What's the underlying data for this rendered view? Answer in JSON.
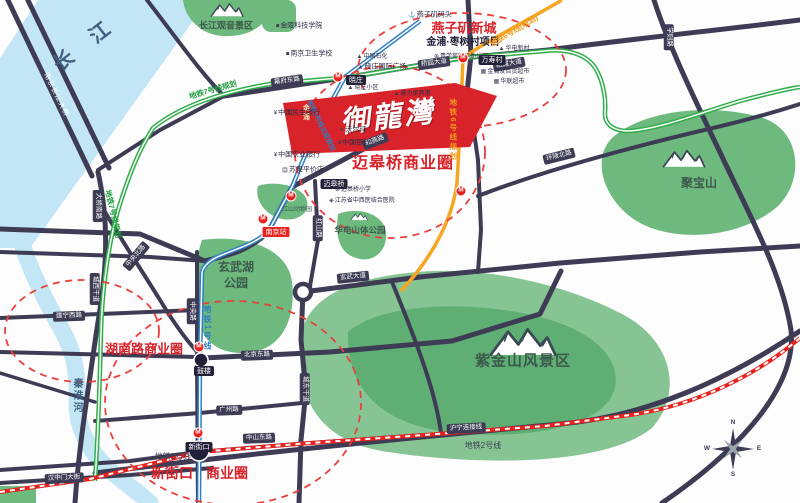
{
  "colors": {
    "road": "#3e3c55",
    "river": "#c2e6f5",
    "park": "#6db97e",
    "park_light": "#86c493",
    "park_dark": "#5fae74",
    "metro_line7": "#2fae4a",
    "metro_line1": "#2e7fc2",
    "metro_line6": "#f5a623",
    "metro_line2": "#e8231f",
    "dashed_circle": "#e8413d",
    "flag": "#d8232a",
    "accent_text": "#d8232a"
  },
  "labels": [
    {
      "name": "yangtze-river-label",
      "text": "长 江",
      "x": 86,
      "y": 44,
      "cls": "river-lg",
      "rot": -38
    },
    {
      "name": "qinhuai-river-label",
      "text": "秦淮河",
      "x": 76,
      "y": 396,
      "cls": "river-sm vtext"
    },
    {
      "name": "bridge-label",
      "text": "南京长江大桥",
      "x": 56,
      "y": 95,
      "cls": "bridge-text",
      "rot": 64
    },
    {
      "name": "guanyin-scenic-label",
      "text": "长江观音景区",
      "x": 226,
      "y": 26,
      "cls": "area area-sm"
    },
    {
      "name": "jubaoshan-label",
      "text": "聚宝山",
      "x": 699,
      "y": 183,
      "cls": "area area-md"
    },
    {
      "name": "xuanwu-lake-label-1",
      "text": "玄武湖",
      "x": 236,
      "y": 267,
      "cls": "area area-md"
    },
    {
      "name": "xuanwu-lake-label-2",
      "text": "公园",
      "x": 236,
      "y": 283,
      "cls": "area area-md"
    },
    {
      "name": "huadian-park-label",
      "text": "华电山体公园",
      "x": 360,
      "y": 230,
      "cls": "area area-xs"
    },
    {
      "name": "zijinshan-label",
      "text": "紫金山风景区",
      "x": 523,
      "y": 361,
      "cls": "area area-lg"
    },
    {
      "name": "hongshan-zoo-label",
      "text": "红山动物园",
      "x": 297,
      "y": 210,
      "cls": "area area-tiny"
    },
    {
      "name": "yanziji-newtown-label",
      "text": "燕子矶新城",
      "x": 464,
      "y": 28,
      "cls": "biz biz-sm"
    },
    {
      "name": "zaoshucun-project-label",
      "text": "金浦·枣树村项目",
      "x": 463,
      "y": 43,
      "cls": "proj"
    },
    {
      "name": "maigaoqiao-biz-label",
      "text": "迈皋桥商业圈",
      "x": 403,
      "y": 164,
      "cls": "biz biz-lg"
    },
    {
      "name": "hunanlu-biz-label",
      "text": "湖南路商业圈",
      "x": 144,
      "y": 349,
      "cls": "biz biz-sm"
    },
    {
      "name": "xinjiekou-biz-label-1",
      "text": "新街口",
      "x": 172,
      "y": 473,
      "cls": "biz biz-md"
    },
    {
      "name": "xinjiekou-biz-label-2",
      "text": "商业圈",
      "x": 227,
      "y": 473,
      "cls": "biz biz-md"
    },
    {
      "name": "flag-brand-small",
      "text": "金浦",
      "x": 306,
      "y": 113,
      "cls": "flag-small vtext"
    },
    {
      "name": "flag-brand-main",
      "text": "御龍灣",
      "x": 388,
      "y": 117,
      "cls": "flag-brand",
      "rot": -7
    },
    {
      "name": "road-tag-daqiaonanlu",
      "text": "大桥南路",
      "x": 98,
      "y": 206,
      "cls": "tag",
      "rot": 90
    },
    {
      "name": "road-tag-chengxigandao",
      "text": "城西干道",
      "x": 95,
      "y": 289,
      "cls": "tag",
      "rot": 90
    },
    {
      "name": "road-tag-mufudonglu",
      "text": "幕府东路",
      "x": 287,
      "y": 81,
      "cls": "tag",
      "rot": -8
    },
    {
      "name": "road-tag-qiaoyuandadao",
      "text": "桥园大道",
      "x": 434,
      "y": 63,
      "cls": "tag",
      "rot": -8
    },
    {
      "name": "road-tag-qixiadadao",
      "text": "栖霞大道",
      "x": 509,
      "y": 64,
      "cls": "tag",
      "rot": -10
    },
    {
      "name": "road-tag-heyanlu",
      "text": "和燕路",
      "x": 375,
      "y": 141,
      "cls": "tag",
      "rot": -21
    },
    {
      "name": "road-tag-hongshanlu",
      "text": "红山路",
      "x": 318,
      "y": 228,
      "cls": "tag",
      "rot": 90
    },
    {
      "name": "road-tag-xuanwudadao",
      "text": "玄武大道",
      "x": 353,
      "y": 277,
      "cls": "tag",
      "rot": -6
    },
    {
      "name": "road-tag-huanlingbeilu",
      "text": "环陵北路",
      "x": 559,
      "y": 156,
      "cls": "tag",
      "rot": -14
    },
    {
      "name": "road-tag-xuezelu",
      "text": "学则路",
      "x": 669,
      "y": 37,
      "cls": "tag",
      "rot": 90
    },
    {
      "name": "road-tag-zhongyangbeilu",
      "text": "中央北路",
      "x": 136,
      "y": 256,
      "cls": "tag",
      "rot": -50
    },
    {
      "name": "road-tag-zhongyanglu",
      "text": "中央路",
      "x": 192,
      "y": 311,
      "cls": "tag",
      "rot": 90
    },
    {
      "name": "road-tag-chengdonggandao",
      "text": "城东干道",
      "x": 305,
      "y": 389,
      "cls": "tag",
      "rot": 90
    },
    {
      "name": "road-tag-beijingdonglu",
      "text": "北京东路",
      "x": 257,
      "y": 355,
      "cls": "tag",
      "rot": -2
    },
    {
      "name": "road-tag-guangzhoulu",
      "text": "广州路",
      "x": 229,
      "y": 410,
      "cls": "tag",
      "rot": -2
    },
    {
      "name": "road-tag-zhongshandonglu",
      "text": "中山东路",
      "x": 259,
      "y": 438,
      "cls": "tag",
      "rot": -2
    },
    {
      "name": "road-tag-hanzhongmen",
      "text": "汉中门大街",
      "x": 64,
      "y": 478,
      "cls": "tag",
      "rot": -3
    },
    {
      "name": "road-tag-huninglianjiexian",
      "text": "沪宁连接线",
      "x": 466,
      "y": 428,
      "cls": "tag",
      "rot": -3
    },
    {
      "name": "road-tag-jianningxilu",
      "text": "建宁西路",
      "x": 69,
      "y": 316,
      "cls": "tag",
      "rot": -2
    },
    {
      "name": "station-tag-xiaozhuang",
      "text": "晓庄",
      "x": 356,
      "y": 80,
      "cls": "stn"
    },
    {
      "name": "station-tag-wanshoucun",
      "text": "万寿村",
      "x": 492,
      "y": 60,
      "cls": "stn"
    },
    {
      "name": "station-tag-maigaoqiao",
      "text": "迈皋桥",
      "x": 334,
      "y": 184,
      "cls": "stn"
    },
    {
      "name": "station-tag-gulou",
      "text": "鼓楼",
      "x": 204,
      "y": 371,
      "cls": "stn"
    },
    {
      "name": "station-tag-xinjiekou",
      "text": "新街口",
      "x": 199,
      "y": 447,
      "cls": "stn"
    },
    {
      "name": "rail-station-tag-nanjing",
      "text": "南京站",
      "x": 276,
      "y": 232,
      "cls": "rail-tag"
    },
    {
      "name": "metro7-label-upper",
      "text": "地铁7号线规划",
      "x": 213,
      "y": 90,
      "cls": "metro-green",
      "rot": -16
    },
    {
      "name": "metro7-label-left",
      "text": "地铁7号线规划",
      "x": 113,
      "y": 214,
      "cls": "metro-green",
      "rot": 77
    },
    {
      "name": "metro1-label",
      "text": "地铁1号线",
      "x": 207,
      "y": 328,
      "cls": "metro-blue vtext"
    },
    {
      "name": "metro1-ext-label",
      "text": "地铁1号线北延规划",
      "x": 320,
      "y": 126,
      "cls": "metro-blue sm",
      "rot": 64
    },
    {
      "name": "metro6-label-upper",
      "text": "地铁6号线(规划)",
      "x": 514,
      "y": 31,
      "cls": "metro-orange",
      "rot": -31
    },
    {
      "name": "metro6-label-lower",
      "text": "地铁6号线规划",
      "x": 453,
      "y": 130,
      "cls": "metro-orange vtext"
    },
    {
      "name": "metro2-label-left",
      "text": "地铁2号线",
      "x": 173,
      "y": 457,
      "cls": "metro-dark"
    },
    {
      "name": "metro2-label-right",
      "text": "地铁2号线",
      "x": 483,
      "y": 446,
      "cls": "metro-dark"
    },
    {
      "name": "poi-jinling-tech",
      "text": "金陵科技学院",
      "icon": "■",
      "x": 299,
      "y": 26,
      "cls": "poi"
    },
    {
      "name": "poi-nanjing-health-school",
      "text": "南京卫生学校",
      "icon": "■",
      "x": 309,
      "y": 54,
      "cls": "poi"
    },
    {
      "name": "poi-yanziji-wharf",
      "text": "燕子矶码头",
      "icon": "⚓",
      "x": 430,
      "y": 15,
      "cls": "poi"
    },
    {
      "name": "poi-kindergarten",
      "text": "青学苑国际幼儿园",
      "icon": "⊕",
      "x": 461,
      "y": 57,
      "cls": "poi sm"
    },
    {
      "name": "poi-sinopec",
      "text": "中国石化",
      "icon": "▲",
      "x": 372,
      "y": 57,
      "cls": "poi sm"
    },
    {
      "name": "poi-xiaozhuang-plaza",
      "text": "晓庄国际广场",
      "icon": "▲",
      "x": 382,
      "y": 67,
      "cls": "poi"
    },
    {
      "name": "poi-xiaozhuang-estate",
      "text": "晓庄小区",
      "icon": "▲",
      "x": 363,
      "y": 88,
      "cls": "poi sm"
    },
    {
      "name": "poi-gaoli-furniture",
      "text": "高力家具港",
      "icon": "▲",
      "x": 412,
      "y": 94,
      "cls": "poi sm"
    },
    {
      "name": "poi-huadian-xincun",
      "text": "华电新村",
      "icon": "▲",
      "x": 514,
      "y": 49,
      "cls": "poi sm"
    },
    {
      "name": "poi-jinrunfa-mall",
      "text": "金润发百货超市",
      "icon": "▦",
      "x": 505,
      "y": 72,
      "cls": "poi sm"
    },
    {
      "name": "poi-hualian-market",
      "text": "华联超市",
      "icon": "▦",
      "x": 509,
      "y": 82,
      "cls": "poi sm"
    },
    {
      "name": "poi-minsheng-bank",
      "text": "中国民生银行",
      "icon": "¥",
      "x": 297,
      "y": 113,
      "cls": "poi"
    },
    {
      "name": "poi-walmart",
      "text": "沃尔玛",
      "icon": "✳",
      "x": 353,
      "y": 130,
      "cls": "poi"
    },
    {
      "name": "poi-bank-of-china",
      "text": "中国银行",
      "icon": "¥",
      "x": 354,
      "y": 143,
      "cls": "poi"
    },
    {
      "name": "poi-agri-bank",
      "text": "中国农业银行",
      "icon": "¥",
      "x": 297,
      "y": 155,
      "cls": "poi"
    },
    {
      "name": "poi-suguo-market",
      "text": "苏果平价店",
      "icon": "▤",
      "x": 303,
      "y": 170,
      "cls": "poi"
    },
    {
      "name": "poi-maigaoqiao-primary",
      "text": "迈皋桥小学",
      "icon": "⊕",
      "x": 353,
      "y": 190,
      "cls": "poi sm"
    },
    {
      "name": "poi-jiangsu-hospital",
      "text": "江苏省中西医结合医院",
      "icon": "◈",
      "x": 362,
      "y": 201,
      "cls": "poi sm"
    },
    {
      "name": "compass-n",
      "text": "N",
      "x": 733,
      "y": 423,
      "cls": "compass-letter"
    },
    {
      "name": "compass-e",
      "text": "E",
      "x": 759,
      "y": 449,
      "cls": "compass-letter"
    },
    {
      "name": "compass-s",
      "text": "S",
      "x": 733,
      "y": 475,
      "cls": "compass-letter"
    },
    {
      "name": "compass-w",
      "text": "W",
      "x": 707,
      "y": 449,
      "cls": "compass-letter"
    }
  ],
  "metro_icons": [
    {
      "name": "metro-icon-xiaozhuang",
      "text": "M",
      "x": 338,
      "y": 77
    },
    {
      "name": "metro-icon-wanshoucun",
      "text": "M",
      "x": 463,
      "y": 58
    },
    {
      "name": "metro-icon-maigaoqiao",
      "text": "M",
      "x": 291,
      "y": 196
    },
    {
      "name": "metro-icon-gulou",
      "text": "M",
      "x": 199,
      "y": 347
    },
    {
      "name": "metro-icon-xinjiekou",
      "text": "M",
      "x": 198,
      "y": 433
    },
    {
      "name": "metro-icon-nanjing-station",
      "text": "M",
      "x": 263,
      "y": 219
    },
    {
      "name": "metro-icon-line6",
      "text": "M",
      "x": 461,
      "y": 191
    }
  ]
}
